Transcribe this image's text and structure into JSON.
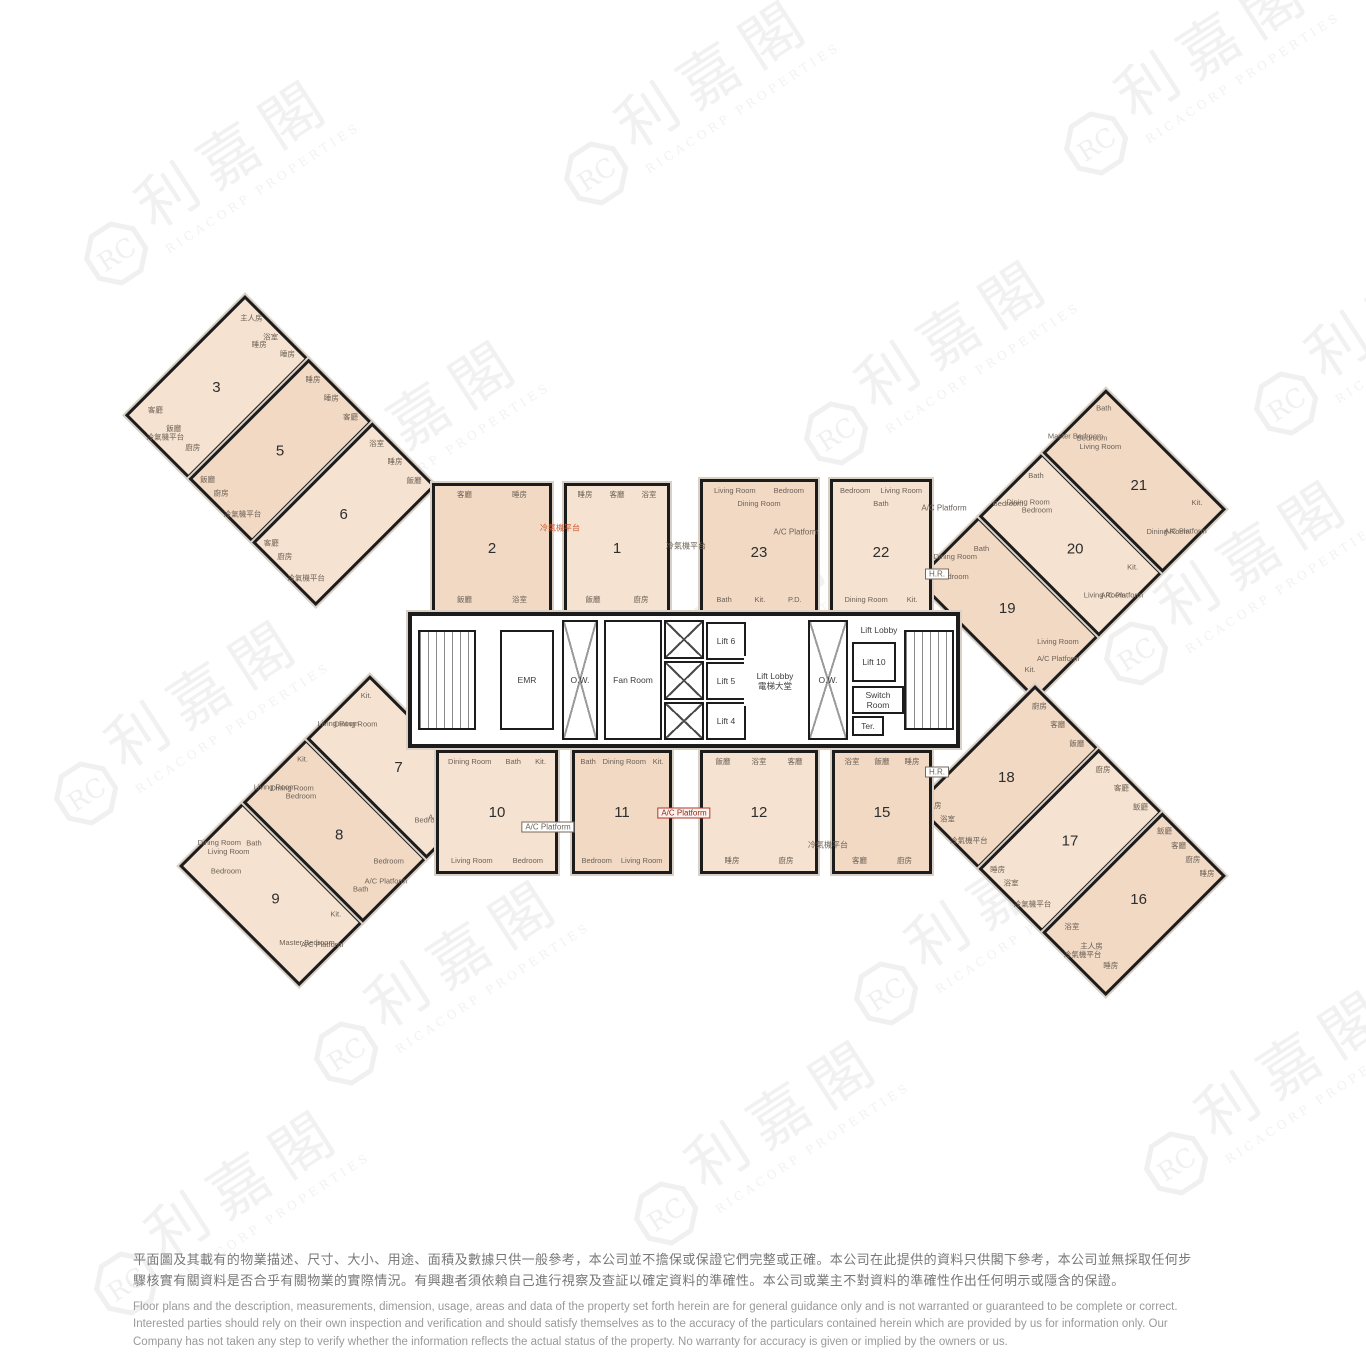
{
  "watermark": {
    "logo_initials": "RC",
    "logo_name": "利嘉閣",
    "company": "RICACORP PROPERTIES"
  },
  "plan": {
    "units": {
      "1": {
        "lang": "zh",
        "rooms": [
          "睡房",
          "客廳",
          "浴室",
          "飯廳",
          "廚房"
        ]
      },
      "2": {
        "lang": "zh",
        "rooms": [
          "客廳",
          "睡房",
          "飯廳",
          "浴室"
        ]
      },
      "3": {
        "lang": "zh",
        "rooms": [
          "主人房",
          "浴室",
          "睡房",
          "睡房",
          "客廳",
          "飯廳",
          "廚房",
          "冷氣機平台"
        ]
      },
      "5": {
        "lang": "zh",
        "rooms": [
          "睡房",
          "睡房",
          "客廳",
          "飯廳",
          "廚房",
          "冷氣機平台"
        ]
      },
      "6": {
        "lang": "zh",
        "rooms": [
          "浴室",
          "睡房",
          "飯廳",
          "客廳",
          "廚房",
          "冷氣機平台"
        ]
      },
      "7": {
        "lang": "en",
        "rooms": [
          "Living Room",
          "Kit.",
          "Dining Room",
          "Bedroom",
          "Bath",
          "A/C Platform"
        ]
      },
      "8": {
        "lang": "en",
        "rooms": [
          "Living Room",
          "Kit.",
          "Dining Room",
          "Bedroom",
          "Bath",
          "Bedroom",
          "A/C Platform"
        ]
      },
      "9": {
        "lang": "en",
        "rooms": [
          "Dining Room",
          "Living Room",
          "Bedroom",
          "Bath",
          "Master Bedroom",
          "Kit.",
          "A/C Platform"
        ]
      },
      "10": {
        "lang": "en",
        "rooms": [
          "Dining Room",
          "Bath",
          "Kit.",
          "Living Room",
          "Bedroom"
        ]
      },
      "11": {
        "lang": "en",
        "rooms": [
          "Bath",
          "Dining Room",
          "Kit.",
          "Bedroom",
          "Living Room"
        ]
      },
      "12": {
        "lang": "zh",
        "rooms": [
          "飯廳",
          "浴室",
          "客廳",
          "睡房",
          "廚房"
        ]
      },
      "15": {
        "lang": "zh",
        "rooms": [
          "浴室",
          "飯廳",
          "睡房",
          "客廳",
          "廚房"
        ]
      },
      "16": {
        "lang": "zh",
        "rooms": [
          "飯廳",
          "客廳",
          "廚房",
          "睡房",
          "浴室",
          "主人房",
          "睡房",
          "冷氣機平台"
        ]
      },
      "17": {
        "lang": "zh",
        "rooms": [
          "廚房",
          "客廳",
          "飯廳",
          "睡房",
          "浴室",
          "冷氣機平台"
        ]
      },
      "18": {
        "lang": "zh",
        "rooms": [
          "廚房",
          "客廳",
          "飯廳",
          "睡房",
          "浴室",
          "冷氣機平台"
        ]
      },
      "19": {
        "lang": "en",
        "rooms": [
          "Dining Room",
          "Bedroom",
          "Bath",
          "Kit.",
          "Living Room",
          "A/C Platform"
        ]
      },
      "20": {
        "lang": "en",
        "rooms": [
          "Bedroom",
          "Bath",
          "Dining Room",
          "Bedroom",
          "Living Room",
          "Kit.",
          "A/C Platform"
        ]
      },
      "21": {
        "lang": "en",
        "rooms": [
          "Master Bedroom",
          "Bath",
          "Bedroom",
          "Living Room",
          "Dining Room",
          "Kit.",
          "A/C Platform"
        ]
      },
      "22": {
        "lang": "en",
        "rooms": [
          "Bedroom",
          "Living Room",
          "Bath",
          "Dining Room",
          "Kit."
        ]
      },
      "23": {
        "lang": "en",
        "rooms": [
          "Living Room",
          "Bedroom",
          "Dining Room",
          "Bath",
          "Kit.",
          "P.D."
        ]
      }
    },
    "core_rooms": [
      {
        "id": "stair-left",
        "label": ""
      },
      {
        "id": "emr",
        "label": "EMR"
      },
      {
        "id": "ow-1",
        "label": "O.W."
      },
      {
        "id": "fan-room",
        "label": "Fan Room"
      },
      {
        "id": "shaft-1",
        "label": ""
      },
      {
        "id": "shaft-2",
        "label": ""
      },
      {
        "id": "shaft-3",
        "label": ""
      },
      {
        "id": "lift-6",
        "label": "Lift 6"
      },
      {
        "id": "lift-5",
        "label": "Lift 5"
      },
      {
        "id": "lift-4",
        "label": "Lift 4"
      },
      {
        "id": "lobby-main",
        "label": "Lift Lobby",
        "label2": "電梯大堂"
      },
      {
        "id": "ow-2",
        "label": "O.W."
      },
      {
        "id": "lobby-2",
        "label": "Lift Lobby"
      },
      {
        "id": "lift-10",
        "label": "Lift 10"
      },
      {
        "id": "switch-room",
        "label": "Switch Room"
      },
      {
        "id": "ter",
        "label": "Ter."
      },
      {
        "id": "stair-right",
        "label": ""
      }
    ],
    "annotations": [
      {
        "text": "冷氣機平台",
        "style": "orange"
      },
      {
        "text": "冷氣機平台",
        "style": "plain"
      },
      {
        "text": "A/C Platform",
        "style": "plain"
      },
      {
        "text": "A/C Platform",
        "style": "plain"
      },
      {
        "text": "A/C Platform",
        "style": "box"
      },
      {
        "text": "A/C Platform",
        "style": "red-box"
      },
      {
        "text": "冷氣機平台",
        "style": "plain"
      },
      {
        "text": "H.R.",
        "style": "box"
      },
      {
        "text": "H.R.",
        "style": "box"
      }
    ]
  },
  "disclaimer": {
    "zh": [
      "平面圖及其載有的物業描述、尺寸、大小、用途、面積及數據只供一般參考，本公司並不擔保或保證它們完整或正確。本公司在此提供的資料只供閣下參考，本公司並無採取任何步",
      "驟核實有關資料是否合乎有關物業的實際情況。有興趣者須依賴自己進行視察及查証以確定資料的準確性。本公司或業主不對資料的準確性作出任何明示或隱含的保證。"
    ],
    "en": [
      "Floor plans and the description, measurements, dimension, usage, areas and data of the property set forth herein are for general guidance only and is not warranted or guaranteed to be complete or correct.",
      "Interested parties should rely on their own inspection and verification and should satisfy themselves as to the accuracy of the particulars contained herein which are provided by us for information only.  Our",
      "Company has not taken any step to verify whether the information reflects the actual status of the property.  No warranty for accuracy is given or implied by the owners or us."
    ]
  }
}
